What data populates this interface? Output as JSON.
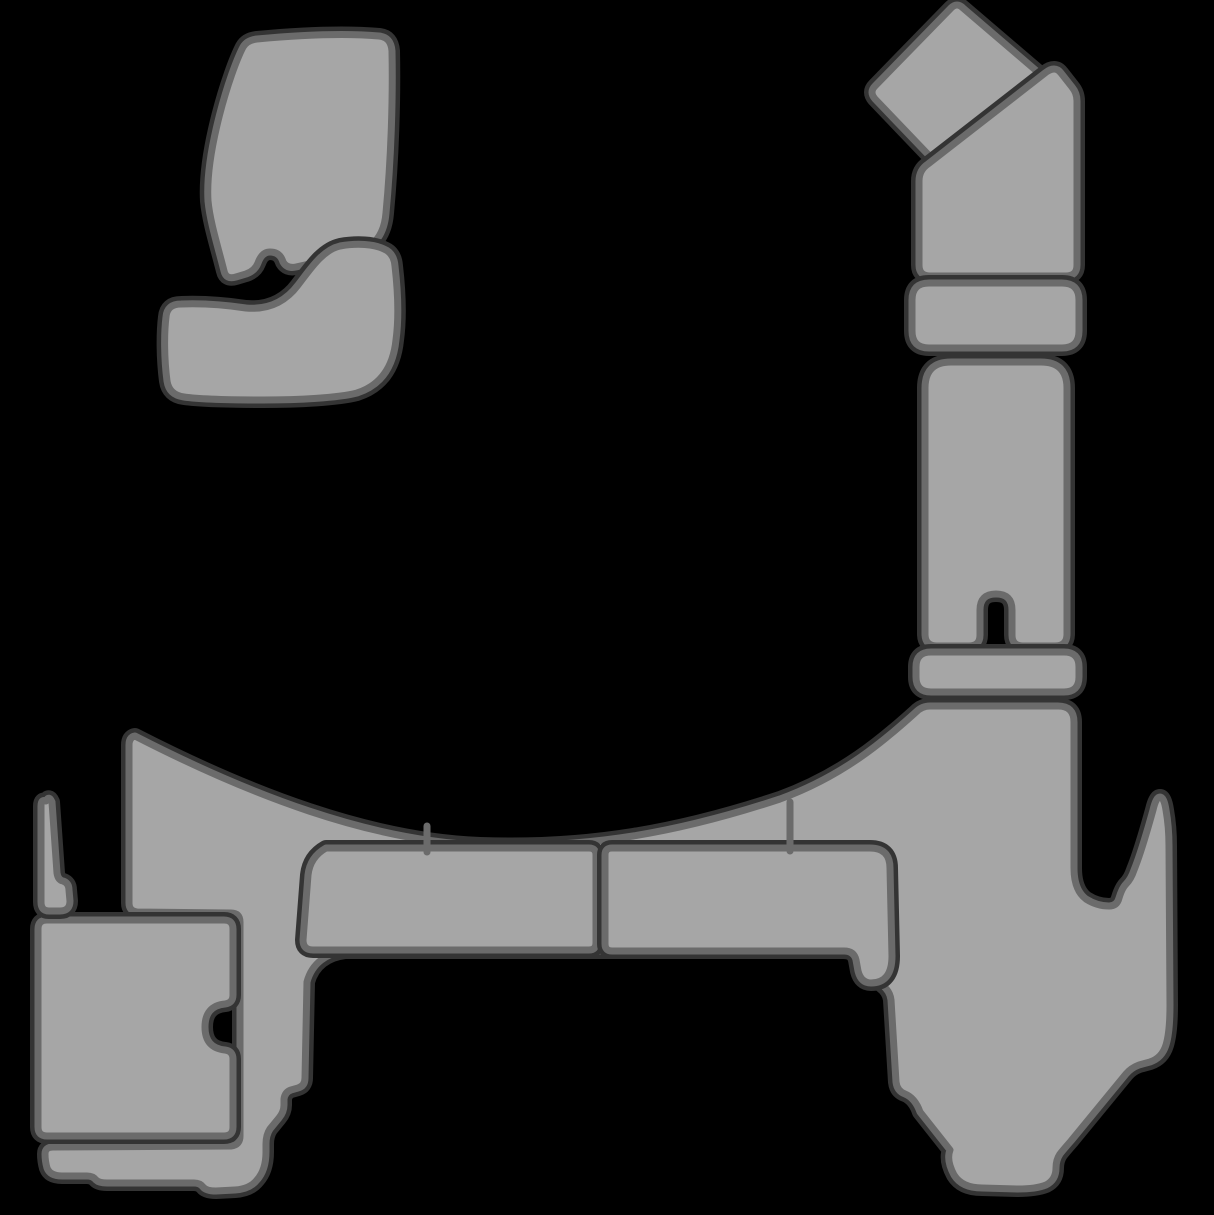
{
  "canvas": {
    "width": 1214,
    "height": 1215,
    "background_color": "#000000"
  },
  "style": {
    "pad_fill_color": "#a6a6a6",
    "outline_color": "#6b6b6b",
    "outline_width": 7,
    "halo_color": "#343434",
    "halo_width": 16,
    "seam_color": "#6b6b6b",
    "seam_width": 7
  },
  "pieces": [
    {
      "name": "main-deck-pad",
      "d": "M 135 736 C 250 795 370 841 480 845 C 590 849 680 832 780 799 C 843 776 884 741 916 712 Q 922 706 930 706 L 1058 706 Q 1074 706 1074 722 L 1074 868 Q 1074 890 1086 899 Q 1097 906 1109 906 Q 1117 906 1119 898 Q 1122 888 1126 884 Q 1131 879 1134 870 C 1141 853 1148 828 1153 810 Q 1156 797 1160 797 Q 1164 797 1166 810 Q 1169 827 1169 846 L 1170 1005 Q 1170 1032 1166 1045 Q 1162 1058 1150 1062 L 1139 1065 Q 1131 1068 1126 1074 L 1071 1141 Q 1064 1149 1060 1154 Q 1056 1160 1056 1168 Q 1056 1180 1046 1185 Q 1036 1189 1018 1189 L 982 1188 Q 962 1188 954 1175 Q 946 1160 950 1150 L 920 1112 Q 915 1098 905 1094 Q 897 1091 896 1082 L 891 1000 Q 890 991 882 985 C 871 975 861 962 855 954 Q 851 951 843 951 L 345 951 C 327 953 312 963 307 982 L 305 1078 Q 305 1086 298 1088 L 291 1090 Q 285 1092 284 1099 L 284 1105 Q 284 1112 279 1118 L 270 1129 Q 266 1135 266 1144 L 266 1152 Q 266 1170 257 1180 Q 250 1189 235 1190 L 216 1191 Q 206 1191 203 1187 Q 200 1183 194 1183 L 107 1183 Q 99 1183 96 1180 Q 93 1176 87 1176 L 62 1176 Q 50 1176 47 1168 Q 45 1161 45 1154 Q 45 1147 53 1147 L 231 1146 Q 240 1145 240 1136 L 240 922 Q 240 913 231 913 L 137 912 Q 129 911 129 903 L 129 745 Q 129 737 135 736 Z"
    },
    {
      "name": "bench-pad-left",
      "d": "M 326 848 L 589 848 Q 596 848 596 855 L 596 943 Q 596 950 589 950 L 313 950 Q 303 950 303 940 L 308 875 Q 310 857 326 848 Z"
    },
    {
      "name": "bench-pad-right",
      "d": "M 612 848 L 870 848 Q 890 848 890 868 L 892 956 Q 892 983 871 983 Q 861 983 858 971 L 856 960 Q 854 951 844 951 L 612 951 Q 605 951 605 944 L 605 855 Q 605 848 612 848 Z"
    },
    {
      "name": "hatch-pad",
      "d": "M 47 920 L 224 920 Q 233 920 233 929 L 233 995 Q 233 1003 225 1004 Q 205 1006 205 1027 Q 205 1048 225 1050 Q 233 1051 233 1059 L 233 1127 Q 233 1136 224 1136 L 47 1136 Q 38 1136 38 1127 L 38 929 Q 38 920 47 920 Z"
    },
    {
      "name": "left-sliver-pad",
      "d": "M 46 801 Q 49 795 52 802 L 57 873 Q 58 880 63 881 Q 69 883 69 890 L 70 901 Q 70 911 60 911 L 49 911 Q 41 911 41 902 L 41 806 Q 41 799 46 801 Z"
    },
    {
      "name": "seat-back-pad",
      "d": "M 257 39 C 300 35 345 33 379 36 Q 391 37 392 51 C 393 100 391 160 386 213 Q 384 238 367 248 C 352 257 338 259 327 260 L 296 267 Q 287 269 283 262 Q 280 252 270 252 Q 262 252 258 263 Q 255 271 246 274 L 236 277 Q 226 280 224 271 C 218 247 210 222 208 201 C 205 152 230 72 243 47 Q 247 40 257 39 Z"
    },
    {
      "name": "seat-bottom-pad",
      "d": "M 340 246 C 357 243 374 244 384 249 Q 394 253 395 266 C 398 292 399 318 396 340 C 393 369 379 386 357 393 C 338 398 298 400 263 400 C 228 400 198 399 184 397 Q 169 395 167 381 C 164 358 164 333 166 317 Q 167 304 181 304 C 206 303 226 305 246 308 C 269 310 286 301 298 285 C 309 271 322 250 340 246 Z"
    },
    {
      "name": "diamond-pad",
      "d": "M 963 8 L 1039 73 Q 1045 79 1039 85 L 953 167 Q 946 173 940 167 L 875 99 Q 869 92 875 86 L 951 8 Q 957 2 963 8 Z"
    },
    {
      "name": "angled-elbow-pad",
      "d": "M 928 164 L 1045 73 Q 1055 65 1061 73 L 1072 87 Q 1077 93 1077 101 L 1077 265 Q 1077 276 1066 276 L 930 276 Q 919 276 919 265 L 919 181 Q 919 170 928 164 Z"
    },
    {
      "name": "short-bar-pad",
      "d": "M 929 283 L 1062 283 Q 1079 283 1079 300 L 1079 331 Q 1079 348 1062 348 L 929 348 Q 912 348 912 331 L 912 300 Q 912 283 929 283 Z"
    },
    {
      "name": "tall-slotted-pad",
      "d": "M 951 362 L 1041 362 Q 1067 362 1067 388 L 1067 634 Q 1067 646 1055 646 L 1023 646 Q 1012 646 1012 635 L 1012 610 Q 1012 594 996 594 Q 980 594 980 610 L 980 635 Q 980 646 969 646 L 937 646 Q 925 646 925 634 L 925 388 Q 925 362 951 362 Z"
    },
    {
      "name": "thin-bar-pad",
      "d": "M 931 652 L 1064 652 Q 1079 652 1079 667 L 1079 677 Q 1079 692 1064 692 L 931 692 Q 916 692 916 677 L 916 667 Q 916 652 931 652 Z"
    }
  ],
  "seams": [
    {
      "name": "deck-seam-left",
      "x1": 427,
      "y1": 826,
      "x2": 427,
      "y2": 852
    },
    {
      "name": "deck-seam-right",
      "x1": 790,
      "y1": 802,
      "x2": 790,
      "y2": 851
    }
  ]
}
